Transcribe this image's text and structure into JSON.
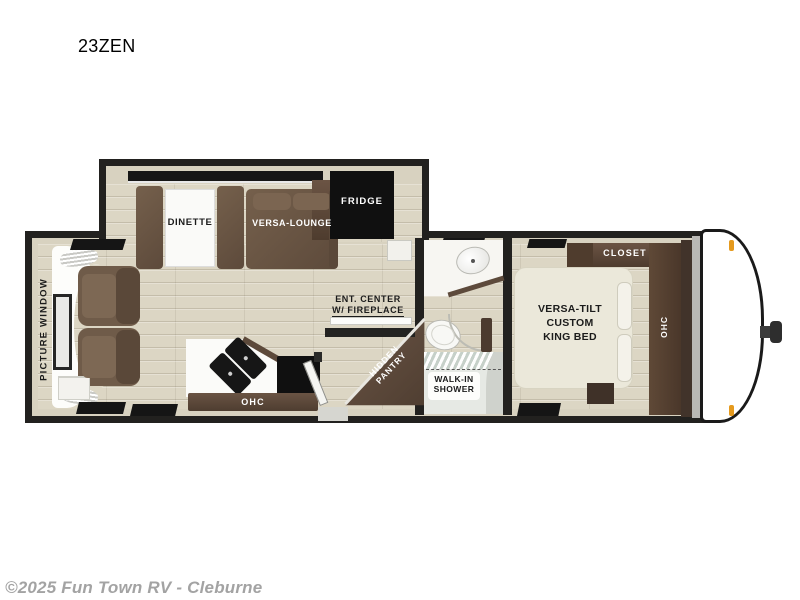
{
  "page": {
    "title": "23ZEN",
    "copyright": "©2025 Fun Town RV - Cleburne"
  },
  "floorplan": {
    "model": "23ZEN",
    "slideout": {
      "dinette_label": "DINETTE",
      "versa_lounge_label": "VERSA-LOUNGE",
      "fridge_label": "FRIDGE"
    },
    "living": {
      "picture_window_label": "PICTURE WINDOW",
      "ent_center_line1": "ENT. CENTER",
      "ent_center_line2": "W/ FIREPLACE",
      "ohc_label": "OHC",
      "hidden_pantry_line1": "HIDDEN",
      "hidden_pantry_line2": "PANTRY"
    },
    "bathroom": {
      "shower_line1": "WALK-IN",
      "shower_line2": "SHOWER"
    },
    "bedroom": {
      "closet_label": "CLOSET",
      "ohc_label": "OHC",
      "bed_line1": "VERSA-TILT",
      "bed_line2": "CUSTOM",
      "bed_line3": "KING BED"
    },
    "colors": {
      "wall": "#22211f",
      "floor": "#dcd6c4",
      "interior_trim": "#d8d2c0",
      "furniture_brown": "#6b5746",
      "cabinet_brown": "#5a4738",
      "appliance_black": "#101010",
      "bed_cream": "#ebe8da",
      "marker_light_amber": "#e59a1e",
      "copyright_gray": "#a3a3a3"
    }
  }
}
